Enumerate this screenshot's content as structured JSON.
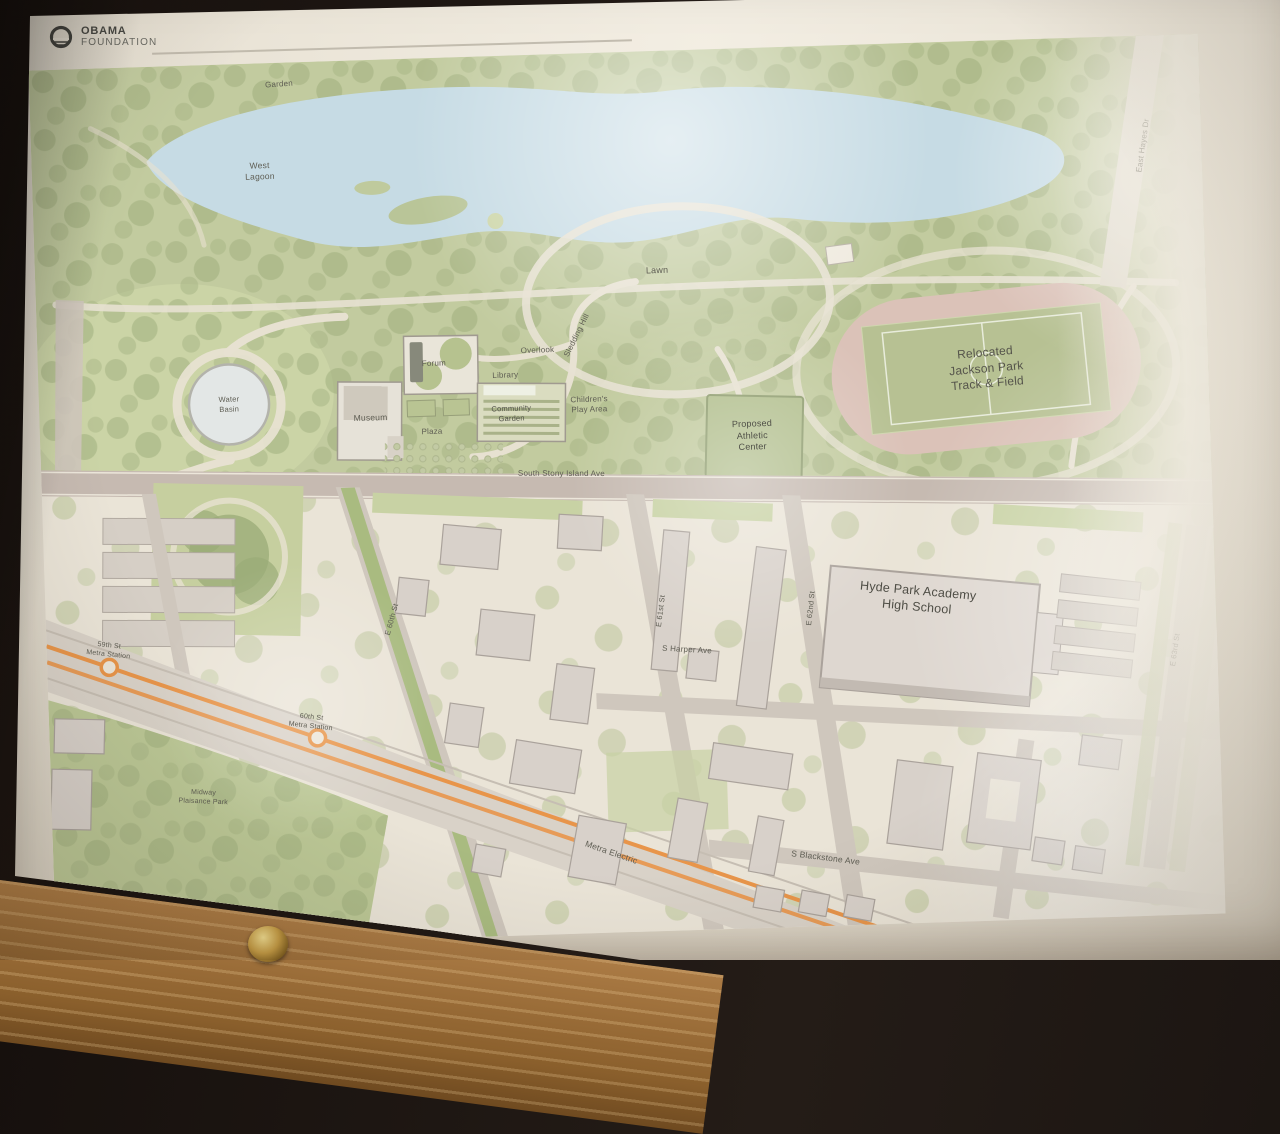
{
  "poster": {
    "logo_line1": "OBAMA",
    "logo_line2": "FOUNDATION"
  },
  "colors": {
    "poster_cream": "#eae4d7",
    "park_green": "#c2cb9f",
    "lagoon_blue": "#c6dbe4",
    "track_pink": "#dbc2b8",
    "rail_orange": "#e8954a",
    "road_grey": "#cfc7bd"
  },
  "map": {
    "labels": [
      {
        "id": "garden",
        "text": "Garden"
      },
      {
        "id": "west-lagoon",
        "text": "West\nLagoon"
      },
      {
        "id": "east-hayes-dr",
        "text": "East Hayes Dr"
      },
      {
        "id": "lawn",
        "text": "Lawn"
      },
      {
        "id": "sledding-hill",
        "text": "Sledding Hill"
      },
      {
        "id": "overlook",
        "text": "Overlook"
      },
      {
        "id": "forum",
        "text": "Forum"
      },
      {
        "id": "library",
        "text": "Library"
      },
      {
        "id": "community-garden",
        "text": "Community\nGarden"
      },
      {
        "id": "museum",
        "text": "Museum"
      },
      {
        "id": "plaza",
        "text": "Plaza"
      },
      {
        "id": "water-basin",
        "text": "Water\nBasin"
      },
      {
        "id": "childrens-play-area",
        "text": "Children's\nPlay Area"
      },
      {
        "id": "athletic-center",
        "text": "Proposed\nAthletic\nCenter"
      },
      {
        "id": "track-field",
        "text": "Relocated\nJackson Park\nTrack & Field"
      },
      {
        "id": "stony-island-ave",
        "text": "South Stony Island Ave"
      },
      {
        "id": "e-60th-st",
        "text": "E 60th St"
      },
      {
        "id": "e-61st-st",
        "text": "E 61st St"
      },
      {
        "id": "e-62nd-st",
        "text": "E 62nd St"
      },
      {
        "id": "e-63rd-st",
        "text": "E 63rd St"
      },
      {
        "id": "s-harper-ave",
        "text": "S Harper Ave"
      },
      {
        "id": "hyde-park-academy",
        "text": "Hyde Park Academy\nHigh School"
      },
      {
        "id": "s-blackstone-ave",
        "text": "S Blackstone Ave"
      },
      {
        "id": "metra-electric",
        "text": "Metra Electric"
      },
      {
        "id": "metra-59th",
        "text": "59th St\nMetra Station"
      },
      {
        "id": "metra-60th",
        "text": "60th St\nMetra Station"
      },
      {
        "id": "midway-plaisance",
        "text": "Midway\nPlaisance Park"
      }
    ]
  }
}
